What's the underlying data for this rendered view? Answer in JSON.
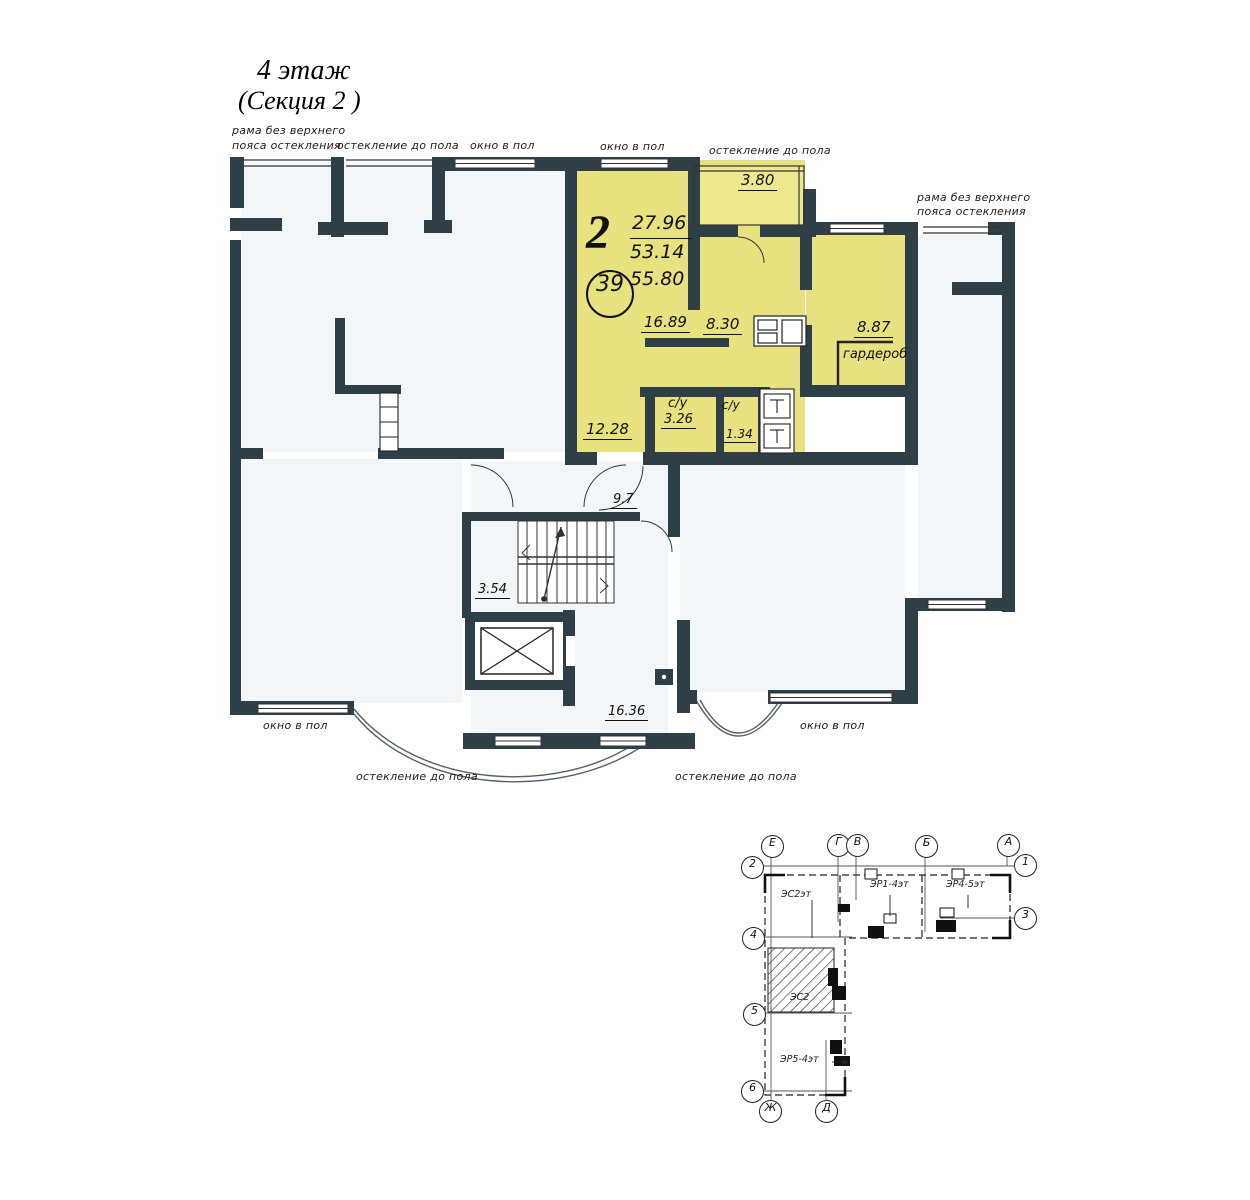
{
  "title": {
    "line1": "4 этаж",
    "line2": "(Секция 2 )"
  },
  "glazing": {
    "frame_top_l1": "рама без верхнего",
    "frame_top_l2": "пояса остекления",
    "glaze_top": "остекление до пола",
    "win_top_1": "окно в пол",
    "win_top_2": "окно в пол",
    "glaze_top_right": "остекление до пола",
    "frame_right_l1": "рама без верхнего",
    "frame_right_l2": "пояса остекления",
    "win_bottom_left": "окно в пол",
    "glaze_bottom_left": "остекление до пола",
    "glaze_bottom_right": "остекление до пола",
    "win_bottom_right": "окно в пол"
  },
  "apartment": {
    "type": "2",
    "area_living_total": "27.96",
    "area_no_balcony": "53.14",
    "area_total": "55.80",
    "number": "39",
    "balcony": "3.80",
    "living": "16.89",
    "kitchen": "8.30",
    "bedroom": "8.87",
    "wardrobe": "гардероб",
    "room2": "12.28",
    "bath_label": "с/у",
    "bath": "3.26",
    "wc_label": "с/у",
    "wc": "1.34"
  },
  "common": {
    "corridor": "9.7",
    "stairs": "3.54",
    "lobby": "16.36"
  },
  "keyplan": {
    "axes": {
      "e": "Е",
      "g": "Г",
      "v": "В",
      "b": "Б",
      "a": "А",
      "n1": "1",
      "n2": "2",
      "n3": "3",
      "n4": "4",
      "n5": "5",
      "n6": "6",
      "zh": "Ж",
      "d": "Д"
    },
    "sections": {
      "s_left": "ЭС2эт",
      "s_mid": "ЭР1-4эт",
      "s_right": "ЭР4-5эт",
      "s_hatch": "ЭС2",
      "s_bottom": "ЭР5-4эт"
    }
  },
  "colors": {
    "wall": "#2e3f47",
    "apartment_fill": "#e7e17f",
    "room_fill": "#f3f6f8"
  }
}
